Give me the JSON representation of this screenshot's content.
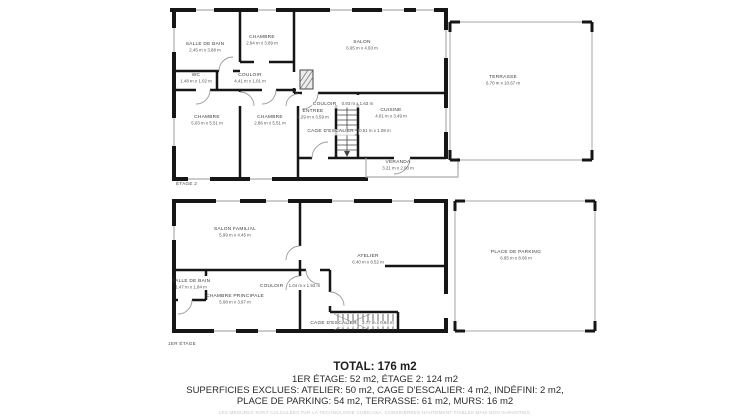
{
  "floors": [
    {
      "label": "ÉTAGE 2",
      "rooms": [
        {
          "name": "SALLE DE BAIN",
          "dims": "2.45 m x 3.88 m"
        },
        {
          "name": "CHAMBRE",
          "dims": "2.94 m x 3.89 m"
        },
        {
          "name": "SALON",
          "dims": "6.95 m x 4.93 m"
        },
        {
          "name": "WC",
          "dims": "1.48 m x 1.02 m"
        },
        {
          "name": "COULOIR",
          "dims": "4.41 m x 1.01 m"
        },
        {
          "name": "CHAMBRE",
          "dims": "5.03 m x 5.51 m"
        },
        {
          "name": "CHAMBRE",
          "dims": "2.86 m x 5.51 m"
        },
        {
          "name": "ENTRÉE",
          "dims": "1.29 m x 3.59 m"
        },
        {
          "name": "COULOIR",
          "dims": "0.93 m x 1.63 m"
        },
        {
          "name": "CAGE D'ESCALIER",
          "dims": "0.51 m x 1.08 m"
        },
        {
          "name": "CUISINE",
          "dims": "4.01 m x 3.49 m"
        },
        {
          "name": "VÉRANDA",
          "dims": "3.21 m x 2.00 m"
        },
        {
          "name": "TERRASSE",
          "dims": "6.70 m x 10.67 m"
        }
      ]
    },
    {
      "label": "1ER ÉTAGE",
      "rooms": [
        {
          "name": "SALON FAMILIAL",
          "dims": "5.99 m x 4.45 m"
        },
        {
          "name": "SALLE DE BAIN",
          "dims": "1.47 m x 1.84 m"
        },
        {
          "name": "CHAMBRE PRINCIPALE",
          "dims": "5.08 m x 3.97 m"
        },
        {
          "name": "COULOIR",
          "dims": "1.04 m x 1.93 m"
        },
        {
          "name": "ATELIER",
          "dims": "6.40 m x 8.52 m"
        },
        {
          "name": "CAGE D'ESCALIER",
          "dims": "2.77 m x 0.94 m"
        },
        {
          "name": "PLACE DE PARKING",
          "dims": "6.95 m x 8.06 m"
        }
      ]
    }
  ],
  "summary": {
    "total": "TOTAL: 176 m2",
    "line2": "1ER ÉTAGE: 52 m2, ÉTAGE 2: 124 m2",
    "line3": "SUPERFICIES EXCLUES: ATELIER: 50 m2, CAGE D'ESCALIER: 4 m2, INDÉFINI: 2 m2,",
    "line4": "PLACE DE PARKING: 54 m2, TERRASSE: 61 m2, MURS: 16 m2"
  },
  "disclaimer": "LES MESURES SONT CALCULÉES PAR LA TECHNOLOGIE CUBICASA, CONSIDÉRÉES HAUTEMENT FIABLES MAIS NON GARANTIES.",
  "colors": {
    "wall": "#161616",
    "window_line": "#9a9a9a",
    "open_area_outline": "#b5b5b5",
    "room_text": "#3f3f3f",
    "summary_text": "#2b2b2b",
    "disclaimer_text": "#c6c6c6",
    "background": "#ffffff"
  }
}
